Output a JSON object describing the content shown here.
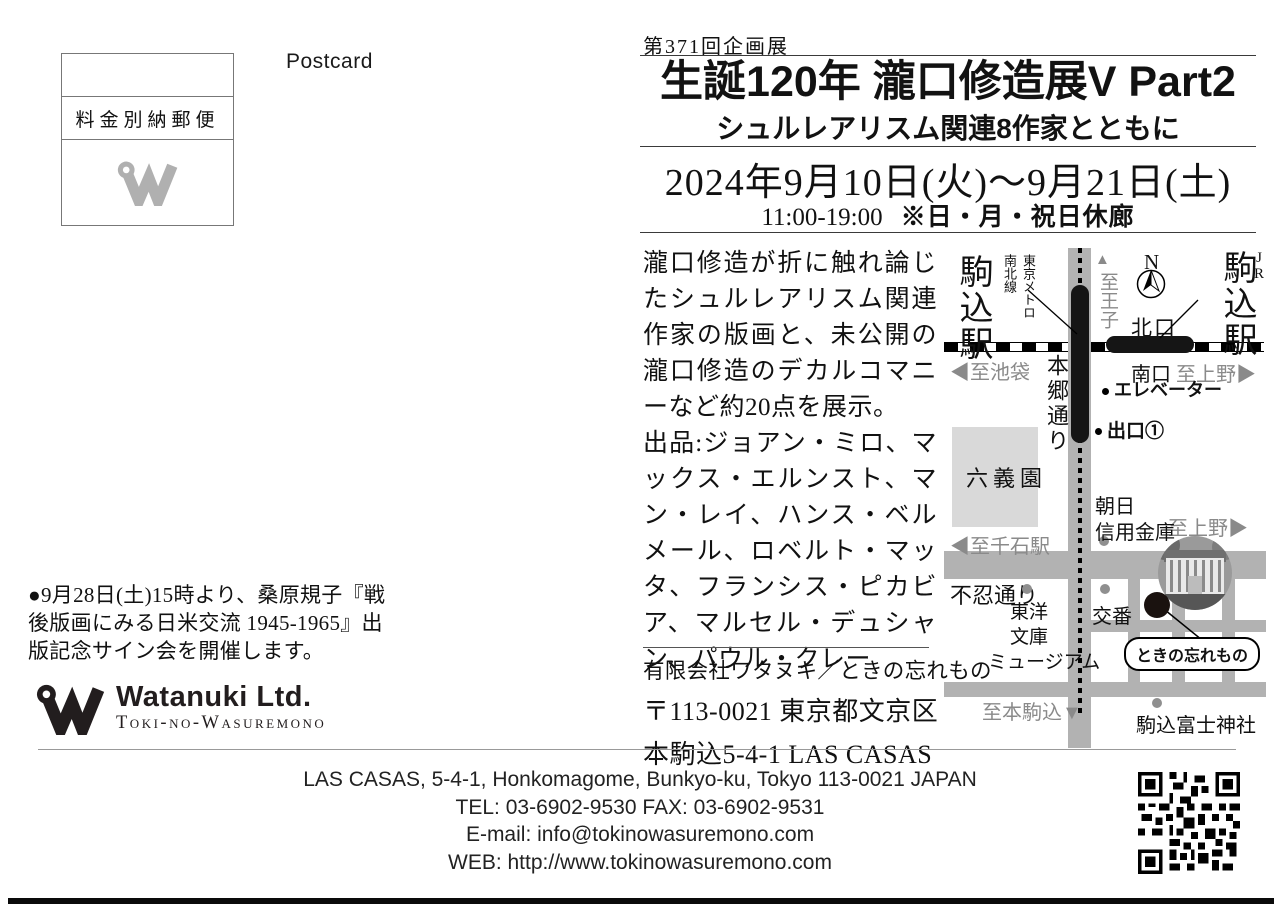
{
  "colors": {
    "road_gray": "#b2b2b2",
    "park_gray": "#d9d9d9",
    "muted_text_gray": "#8a8a8a",
    "ink_black": "#111111"
  },
  "left": {
    "postcard": "Postcard",
    "stamp_label": "料金別納郵便",
    "event_note": "●9月28日(土)15時より、桑原規子『戦後版画にみる日米交流 1945-1965』出版記念サイン会を開催します。",
    "logo_name": "Watanuki Ltd.",
    "logo_sub": "Toki-no-Wasuremono"
  },
  "header": {
    "series": "第371回企画展",
    "title": "生誕120年 瀧口修造展V Part2",
    "subtitle": "シュルレアリスム関連8作家とともに",
    "dates": "2024年9月10日(火)〜9月21日(土)",
    "hours": "11:00-19:00",
    "closed_note": "※日・月・祝日休廊"
  },
  "body": {
    "description": "瀧口修造が折に触れ論じたシュルレアリスム関連作家の版画と、未公開の瀧口修造のデカルコマニーなど約20点を展示。",
    "artists": "出品:ジョアン・ミロ、マックス・エルンスト、マン・レイ、ハンス・ベルメール、ロベルト・マッタ、フランシス・ピカビア、マルセル・デュシャン、パウル・クレー",
    "company_line": "有限会社ワタヌキ／ときの忘れもの",
    "postal_line": "〒113-0021 東京都文京区",
    "street_line": "本駒込5-4-1 LAS CASAS"
  },
  "map": {
    "station_left": "駒込駅",
    "metro_note_1": "東京メトロ",
    "metro_note_2": "南北線",
    "up_triangle": "▲",
    "to_oji": "至王子",
    "north": "N",
    "jr": "JR",
    "station_right": "駒込駅",
    "north_exit": "北口",
    "to_ikebukuro": "◀至池袋",
    "south_exit": "南口",
    "to_ueno_station": "至上野▶",
    "hongo_dori": "本郷通り",
    "elevator": "エレベーター",
    "exit_1": "出口①",
    "rikugien": "六義園",
    "asahi_bank_1": "朝日",
    "asahi_bank_2": "信用金庫",
    "to_ueno_road": "至上野▶",
    "to_sengoku": "◀至千石駅",
    "shinobazu_dori": "不忍通り",
    "toyo_bunko_1": "東洋",
    "toyo_bunko_2": "文庫",
    "toyo_bunko_3": "ミュージアム",
    "koban": "交番",
    "gallery_label": "ときの忘れもの",
    "to_honkomagome": "至本駒込▼",
    "fuji_shrine": "駒込富士神社"
  },
  "footer": {
    "address_en": "LAS CASAS, 5-4-1, Honkomagome, Bunkyo-ku,  Tokyo 113-0021 JAPAN",
    "tel_fax": "TEL: 03-6902-9530  FAX: 03-6902-9531",
    "email": "E-mail: info@tokinowasuremono.com",
    "web": "WEB: http://www.tokinowasuremono.com"
  }
}
